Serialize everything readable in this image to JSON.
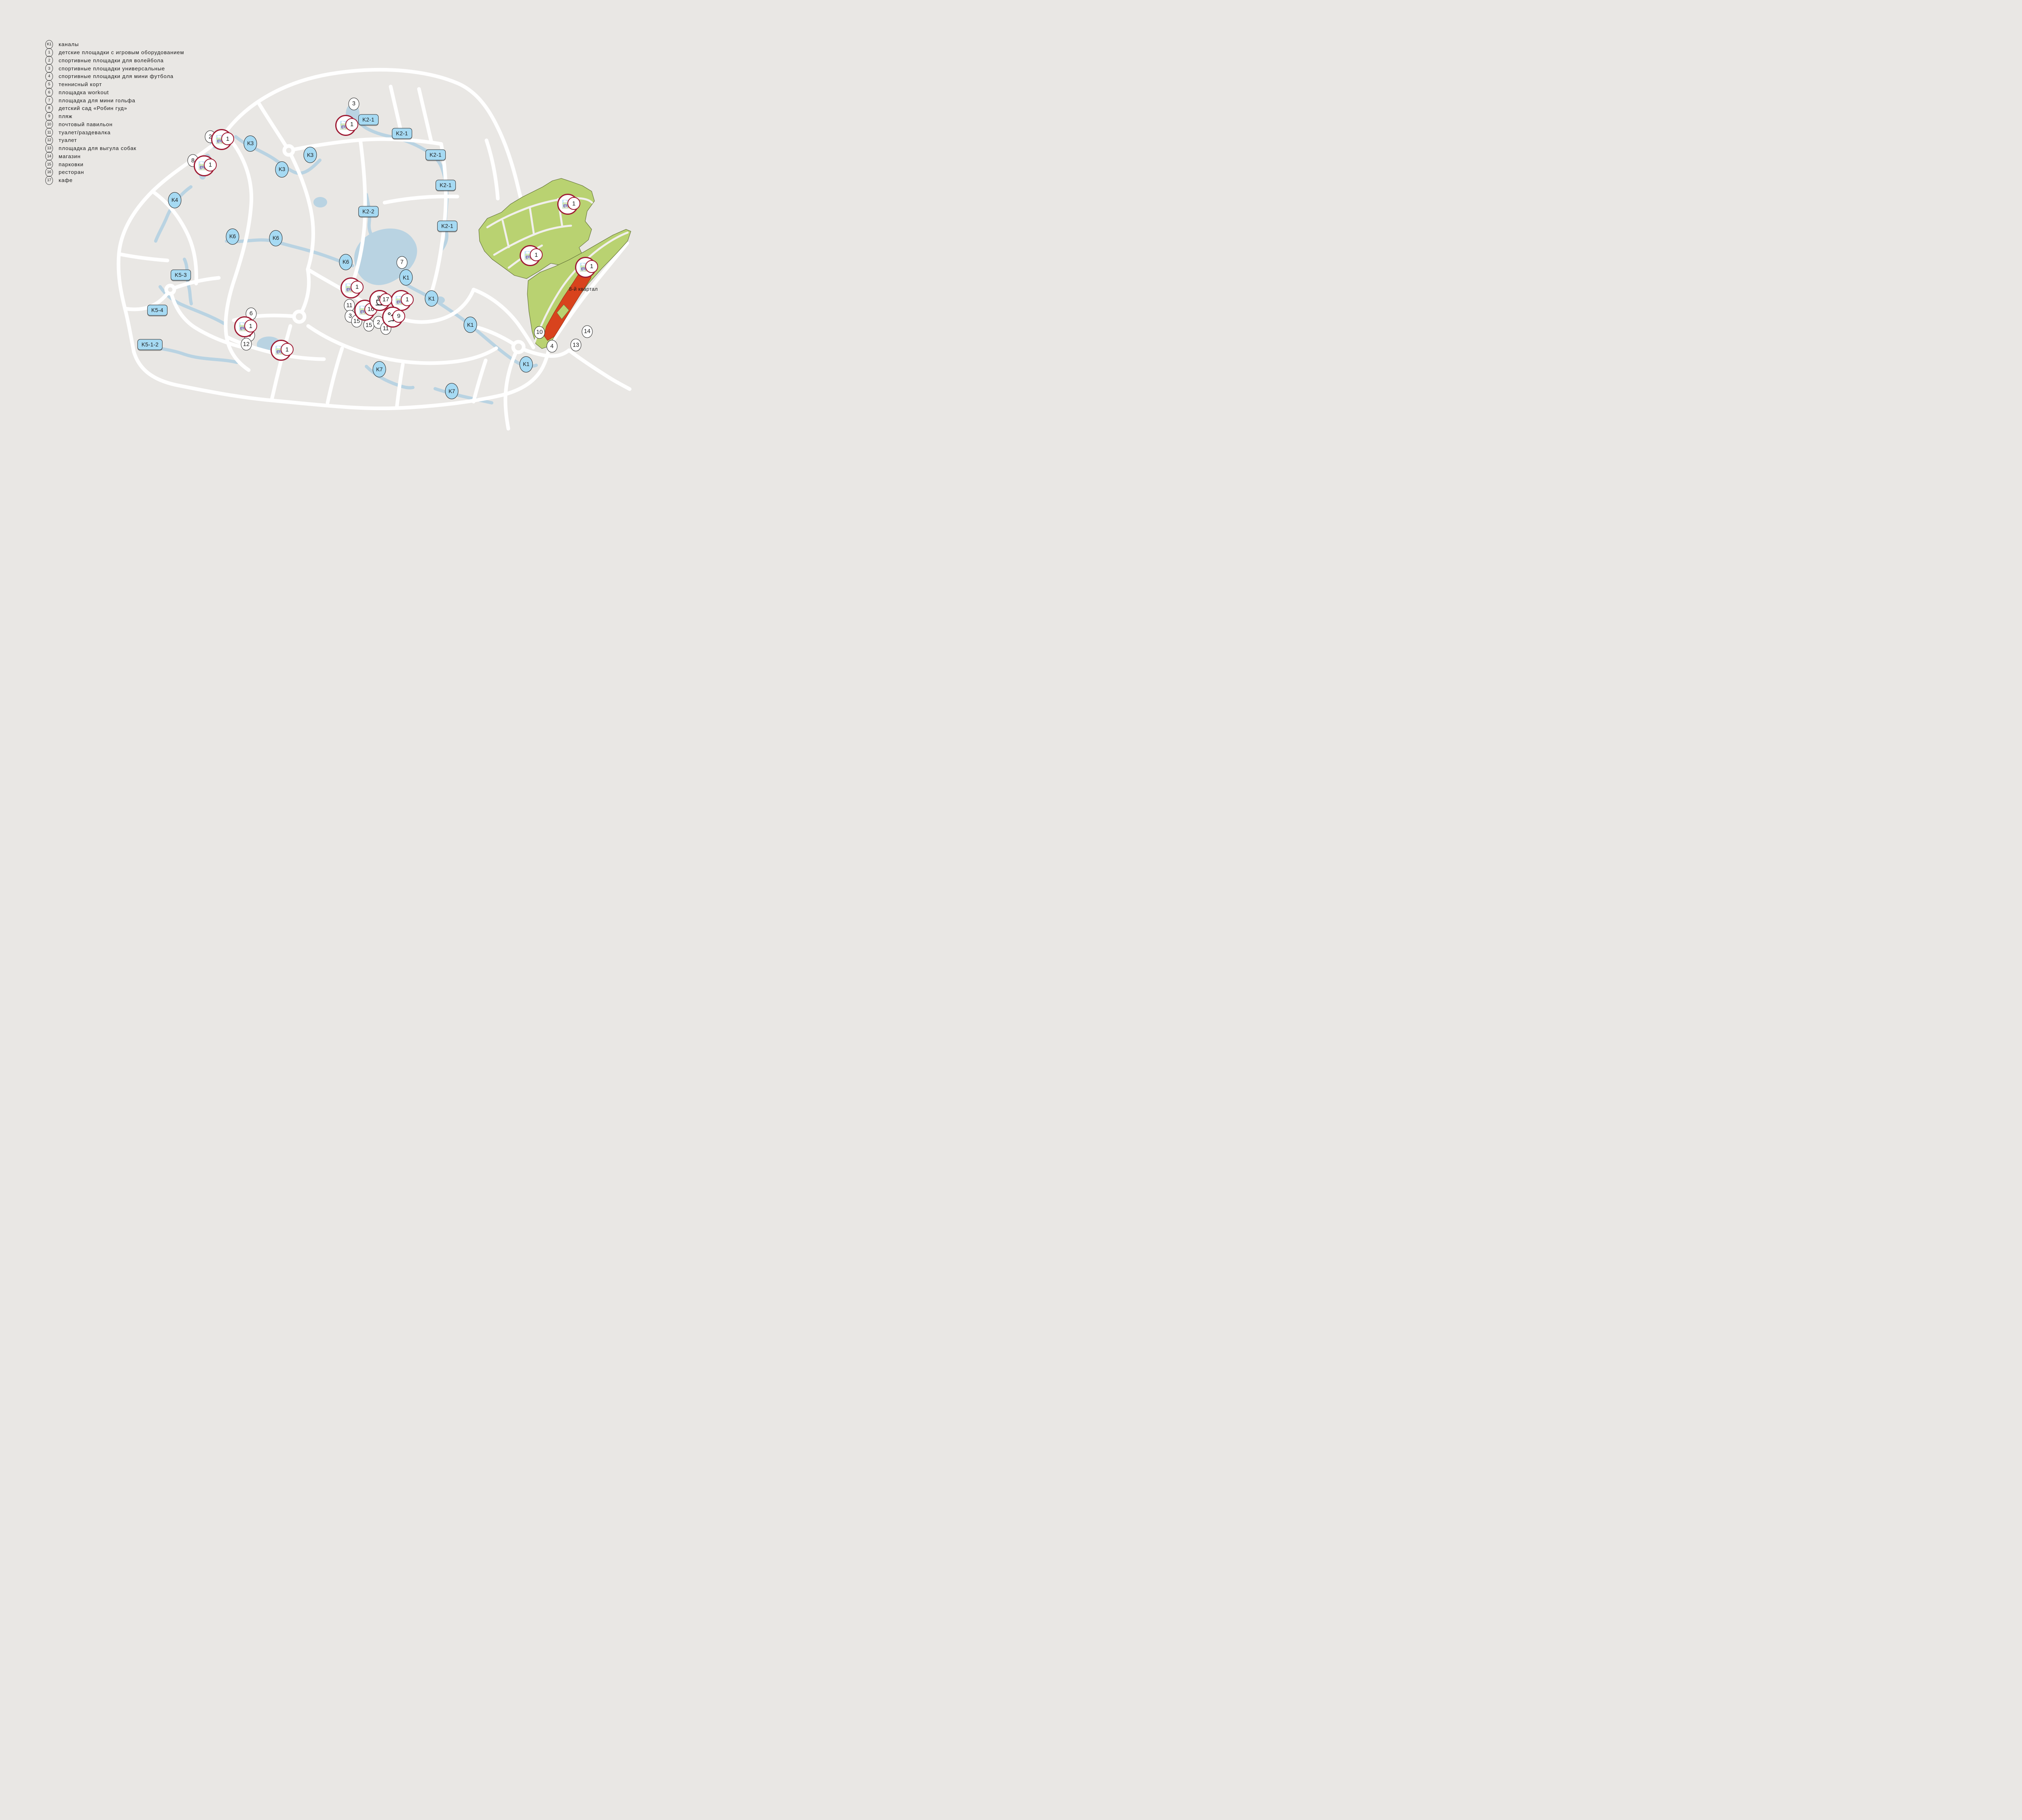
{
  "colors": {
    "background": "#e9e7e4",
    "road": "#ffffff",
    "water": "#b9d3e2",
    "canal_label": "#a6daf3",
    "parcel_green": "#b9d271",
    "highlight_red": "#d8431d",
    "marker_ring_crimson": "#9e1a33"
  },
  "legend": {
    "items": [
      {
        "key": "K1",
        "label": "каналы"
      },
      {
        "key": "1",
        "label": "детские площадки с игровым оборудованием"
      },
      {
        "key": "2",
        "label": "спортивные площадки для волейбола"
      },
      {
        "key": "3",
        "label": "спортивные площадки универсальные"
      },
      {
        "key": "4",
        "label": "спортивные площадки для мини футбола"
      },
      {
        "key": "5",
        "label": "теннисный корт"
      },
      {
        "key": "6",
        "label": "площадка workout"
      },
      {
        "key": "7",
        "label": "площадка для мини гольфа"
      },
      {
        "key": "8",
        "label": "детский сад «Робин гуд»"
      },
      {
        "key": "9",
        "label": "пляж"
      },
      {
        "key": "10",
        "label": "почтовый павильон"
      },
      {
        "key": "11",
        "label": "туалет/раздевалка"
      },
      {
        "key": "12",
        "label": "туалет"
      },
      {
        "key": "13",
        "label": "площадка для выгула собак"
      },
      {
        "key": "14",
        "label": "магазин"
      },
      {
        "key": "15",
        "label": "парковки"
      },
      {
        "key": "16",
        "label": "ресторан"
      },
      {
        "key": "17",
        "label": "кафе"
      }
    ]
  },
  "map": {
    "canal_labels": [
      {
        "text": "K3",
        "shape": "oval",
        "x": 39.48,
        "y": 32.01
      },
      {
        "text": "K3",
        "shape": "oval",
        "x": 48.92,
        "y": 34.54
      },
      {
        "text": "K3",
        "shape": "oval",
        "x": 44.45,
        "y": 37.78
      },
      {
        "text": "K4",
        "shape": "oval",
        "x": 27.55,
        "y": 44.63
      },
      {
        "text": "K6",
        "shape": "oval",
        "x": 36.67,
        "y": 52.75
      },
      {
        "text": "K6",
        "shape": "oval",
        "x": 43.49,
        "y": 53.11
      },
      {
        "text": "K6",
        "shape": "oval",
        "x": 54.53,
        "y": 58.43
      },
      {
        "text": "K1",
        "shape": "oval",
        "x": 64.03,
        "y": 61.86
      },
      {
        "text": "K1",
        "shape": "oval",
        "x": 68.05,
        "y": 66.55
      },
      {
        "text": "K1",
        "shape": "oval",
        "x": 74.17,
        "y": 72.41
      },
      {
        "text": "K1",
        "shape": "oval",
        "x": 82.97,
        "y": 81.24
      },
      {
        "text": "K7",
        "shape": "oval",
        "x": 59.82,
        "y": 82.33
      },
      {
        "text": "K7",
        "shape": "oval",
        "x": 71.24,
        "y": 87.2
      },
      {
        "text": "K2-1",
        "shape": "rect",
        "x": 58.1,
        "y": 26.69
      },
      {
        "text": "K2-1",
        "shape": "rect",
        "x": 63.39,
        "y": 29.76
      },
      {
        "text": "K2-1",
        "shape": "rect",
        "x": 68.69,
        "y": 34.54
      },
      {
        "text": "K2-1",
        "shape": "rect",
        "x": 70.28,
        "y": 41.3
      },
      {
        "text": "K2-2",
        "shape": "rect",
        "x": 58.1,
        "y": 47.16
      },
      {
        "text": "K2-1",
        "shape": "rect",
        "x": 70.54,
        "y": 50.41
      },
      {
        "text": "K5-3",
        "shape": "rect",
        "x": 28.51,
        "y": 61.32
      },
      {
        "text": "K5-4",
        "shape": "rect",
        "x": 24.81,
        "y": 69.16
      },
      {
        "text": "K5-1-2",
        "shape": "rect",
        "x": 23.66,
        "y": 76.83
      }
    ],
    "amenity_markers": [
      {
        "num": "3",
        "x": 55.8,
        "y": 23.17
      },
      {
        "num": "2",
        "x": 33.16,
        "y": 30.48
      },
      {
        "num": "8",
        "x": 30.42,
        "y": 35.8
      },
      {
        "num": "7",
        "x": 63.39,
        "y": 58.52
      },
      {
        "num": "11",
        "x": 55.1,
        "y": 68.08
      },
      {
        "num": "3",
        "x": 55.23,
        "y": 70.51
      },
      {
        "num": "15",
        "x": 56.25,
        "y": 71.6
      },
      {
        "num": "15",
        "x": 58.16,
        "y": 72.5
      },
      {
        "num": "2",
        "x": 59.69,
        "y": 71.87
      },
      {
        "num": "11",
        "x": 60.84,
        "y": 73.22
      },
      {
        "num": "6",
        "x": 39.6,
        "y": 69.97
      },
      {
        "num": "5",
        "x": 39.35,
        "y": 74.75
      },
      {
        "num": "12",
        "x": 38.84,
        "y": 76.74
      },
      {
        "num": "10",
        "x": 85.08,
        "y": 74.12
      },
      {
        "num": "14",
        "x": 92.6,
        "y": 73.94
      },
      {
        "num": "4",
        "x": 87.05,
        "y": 77.19
      },
      {
        "num": "13",
        "x": 90.82,
        "y": 76.92
      }
    ],
    "icon_markers": [
      {
        "icon": "playground",
        "num": "1",
        "x": 34.95,
        "y": 31.11
      },
      {
        "icon": "playground",
        "num": "1",
        "x": 32.21,
        "y": 36.97
      },
      {
        "icon": "playground",
        "num": "1",
        "x": 54.53,
        "y": 27.95
      },
      {
        "icon": "playground",
        "num": "1",
        "x": 55.36,
        "y": 64.2
      },
      {
        "icon": "playground",
        "num": "16",
        "x": 57.53,
        "y": 69.16
      },
      {
        "icon": "playground",
        "num": "1",
        "x": 63.27,
        "y": 66.99
      },
      {
        "icon": "cafe",
        "num": "17",
        "x": 59.88,
        "y": 66.99
      },
      {
        "icon": "beach",
        "num": "9",
        "x": 61.93,
        "y": 70.69
      },
      {
        "icon": "playground",
        "num": "1",
        "x": 38.58,
        "y": 72.86
      },
      {
        "icon": "playground",
        "num": "1",
        "x": 44.32,
        "y": 78.09
      },
      {
        "icon": "playground",
        "num": "1",
        "x": 89.54,
        "y": 45.54
      },
      {
        "icon": "playground",
        "num": "1",
        "x": 83.61,
        "y": 56.99
      },
      {
        "icon": "playground",
        "num": "1",
        "x": 92.35,
        "y": 59.6
      }
    ],
    "texts": [
      {
        "text": "8-й квартал",
        "x": 92.0,
        "y": 64.5
      }
    ]
  }
}
